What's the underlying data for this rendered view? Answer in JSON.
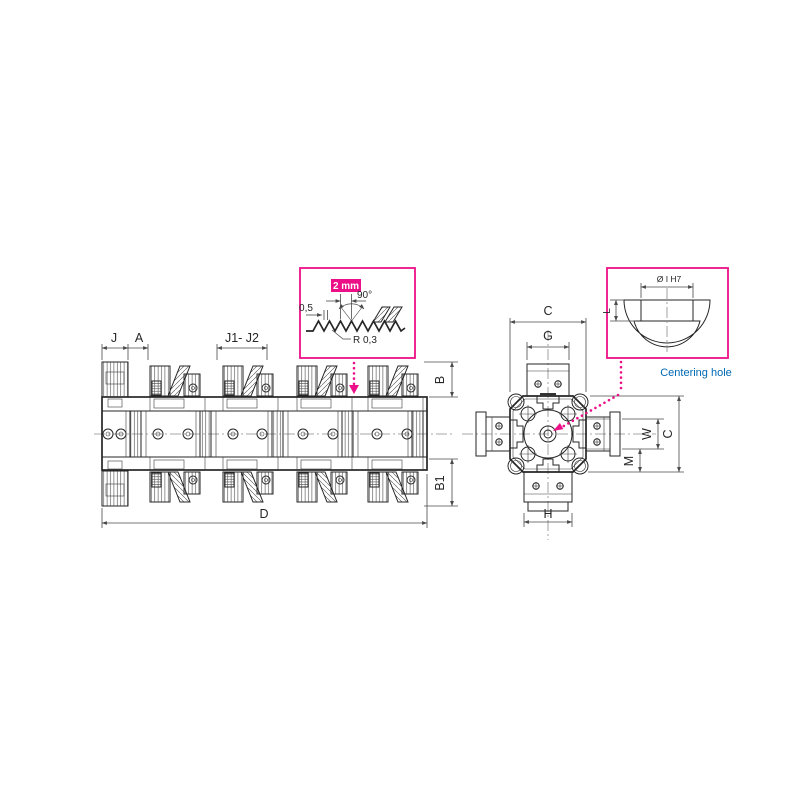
{
  "colors": {
    "accent_magenta": "#ec0f87",
    "callout_blue": "#0068b4",
    "drawing_line": "#262626",
    "dimension_line": "#4a4a4a"
  },
  "side_view": {
    "description": "multi-station clamping bar side view",
    "dim_j": "J",
    "dim_a": "A",
    "dim_j1_j2": "J1- J2",
    "dim_b": "B",
    "dim_b1": "B1",
    "dim_d": "D"
  },
  "end_view": {
    "description": "clamping bar end cross-section view",
    "dim_c_top": "C",
    "dim_g": "G",
    "dim_w": "W",
    "dim_m": "M",
    "dim_c_side": "C",
    "dim_h": "H"
  },
  "serration_detail": {
    "pitch": "2 mm",
    "angle": "90°",
    "land": "0,5",
    "radius": "R 0,3"
  },
  "centering_detail": {
    "diameter": "Ø I H7",
    "depth": "L",
    "caption": "Centering hole"
  }
}
